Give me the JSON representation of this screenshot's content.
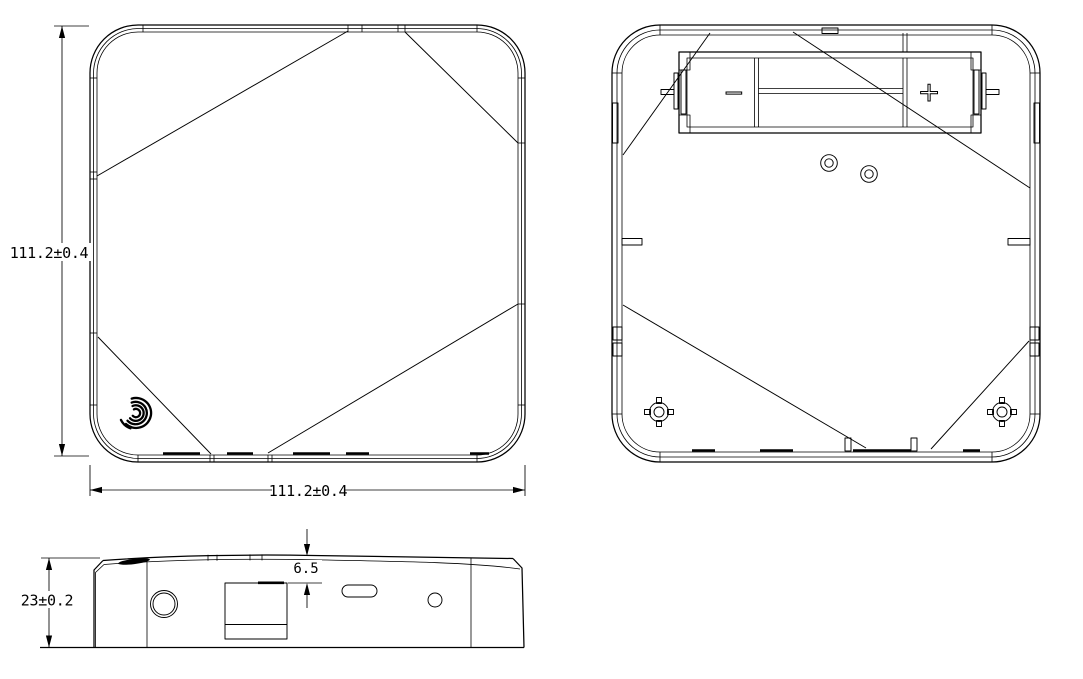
{
  "colors": {
    "background": "#ffffff",
    "line": "#000000"
  },
  "dimensions": {
    "front_height": "111.2±0.4",
    "front_width": "111.2±0.4",
    "side_height": "23±0.2",
    "side_top_recess": "6.5"
  },
  "battery": {
    "negative_label": "−",
    "positive_label": "+"
  },
  "icons": {
    "fingerprint": "fingerprint-swirl-icon",
    "mounting_boss": "crosshair-boss-icon"
  }
}
